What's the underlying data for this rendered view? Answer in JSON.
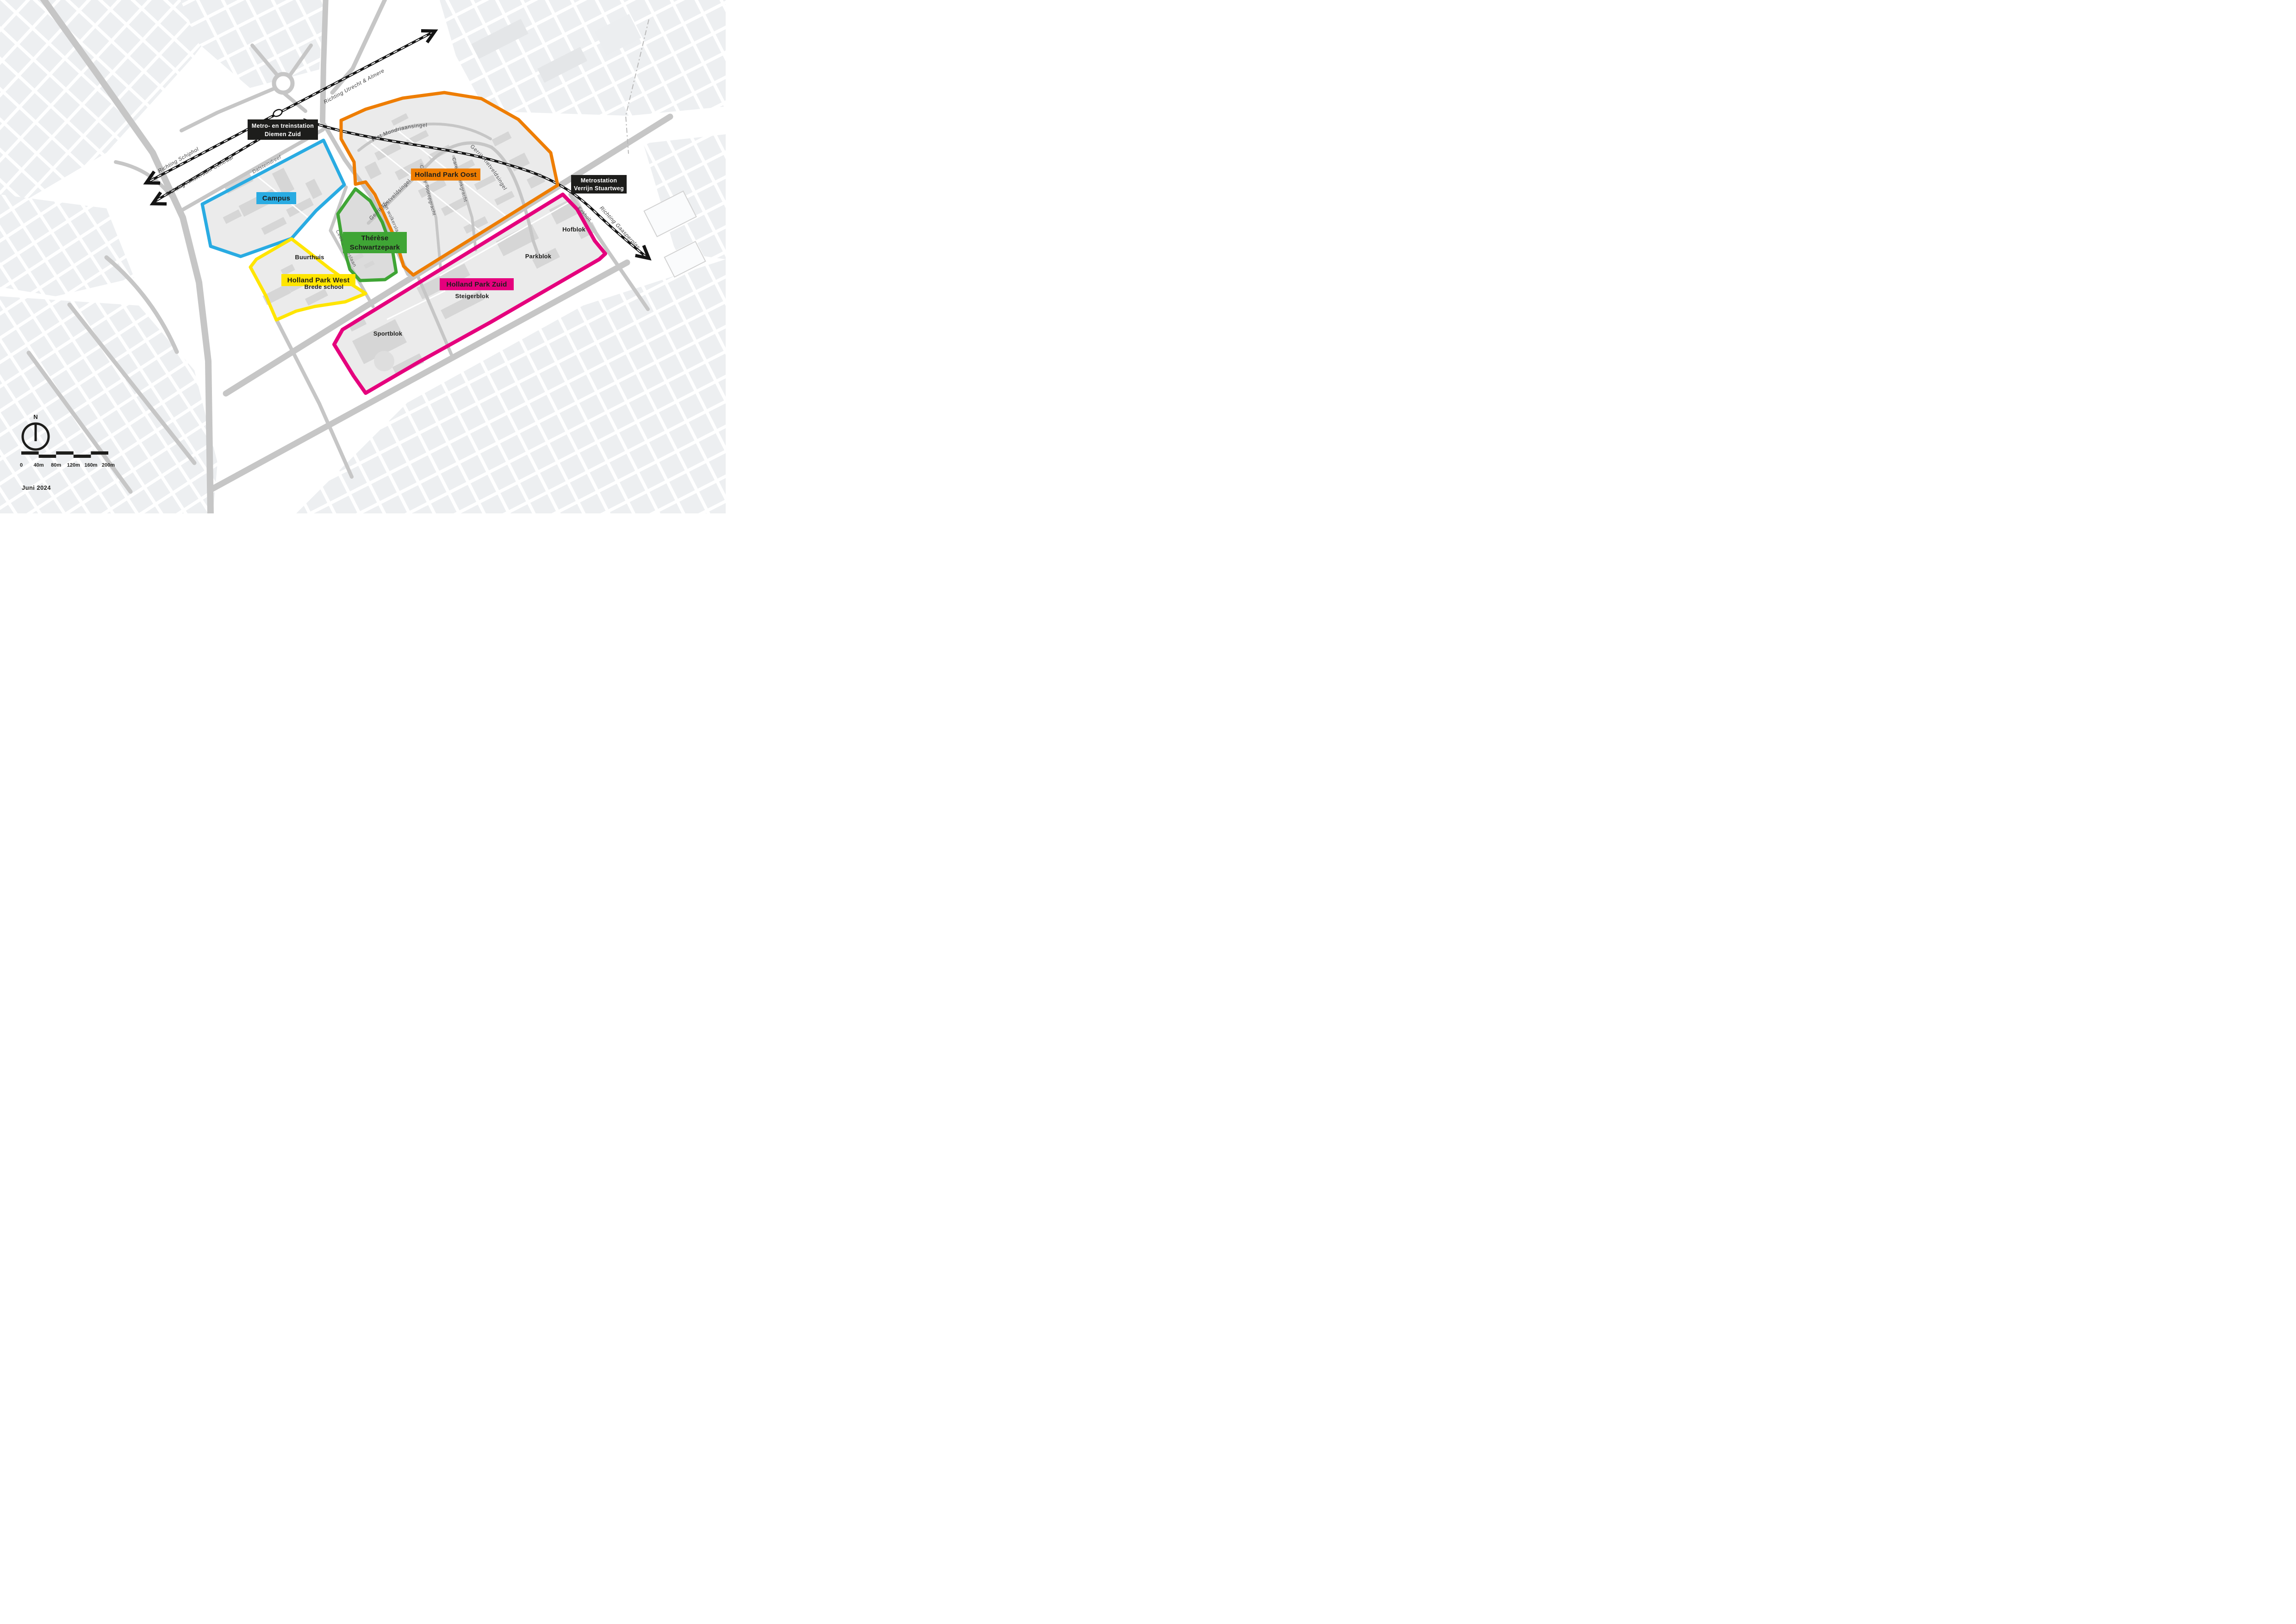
{
  "colors": {
    "campus": "#29abe2",
    "west": "#ffe500",
    "park": "#3fa535",
    "oost": "#ee7d00",
    "zuid": "#e5007d",
    "station_box": "#1d1d1b"
  },
  "zones": {
    "campus": {
      "label": "Campus"
    },
    "west": {
      "label": "Holland Park West"
    },
    "park": {
      "line1": "Thérèse",
      "line2": "Schwartzepark"
    },
    "oost": {
      "label": "Holland Park Oost"
    },
    "zuid": {
      "label": "Holland Park Zuid"
    }
  },
  "stations": {
    "diemen_zuid": {
      "line1": "Metro- en treinstation",
      "line2": "Diemen Zuid"
    },
    "verrijn": {
      "line1": "Metrostation",
      "line2": "Verrijn Stuartweg"
    }
  },
  "blocks": {
    "buurthuis": "Buurthuis",
    "brede_school": "Brede school",
    "hofblok": "Hofblok",
    "parkblok": "Parkblok",
    "steigerblok": "Steigerblok",
    "sportblok": "Sportblok"
  },
  "streets": {
    "dalsteindreef": "Dalsteindreef",
    "piet": "Piet Mondriaansingel",
    "gerrit_n": "Gerrit Rietveldsingel",
    "gerrit_se": "Gerrit Rietveldsingel",
    "carel": "Carel Willinkgracht",
    "charley": "Charley Tooropgracht",
    "jan": "Jan wolkerslaan",
    "cees": "Cees Sipkeslaan",
    "eekholt": "Eekholt"
  },
  "directions": {
    "utrecht": "Richting Utrecht & Almere",
    "schiphol": "Richting Schiphol",
    "amsterdam": "Richting Amsterdam Centraal",
    "gaasperplas": "Richting Gaasperplas"
  },
  "legend": {
    "north": "N",
    "date": "Juni 2024",
    "scale_ticks": [
      "0",
      "40m",
      "80m",
      "120m",
      "160m",
      "200m"
    ]
  }
}
